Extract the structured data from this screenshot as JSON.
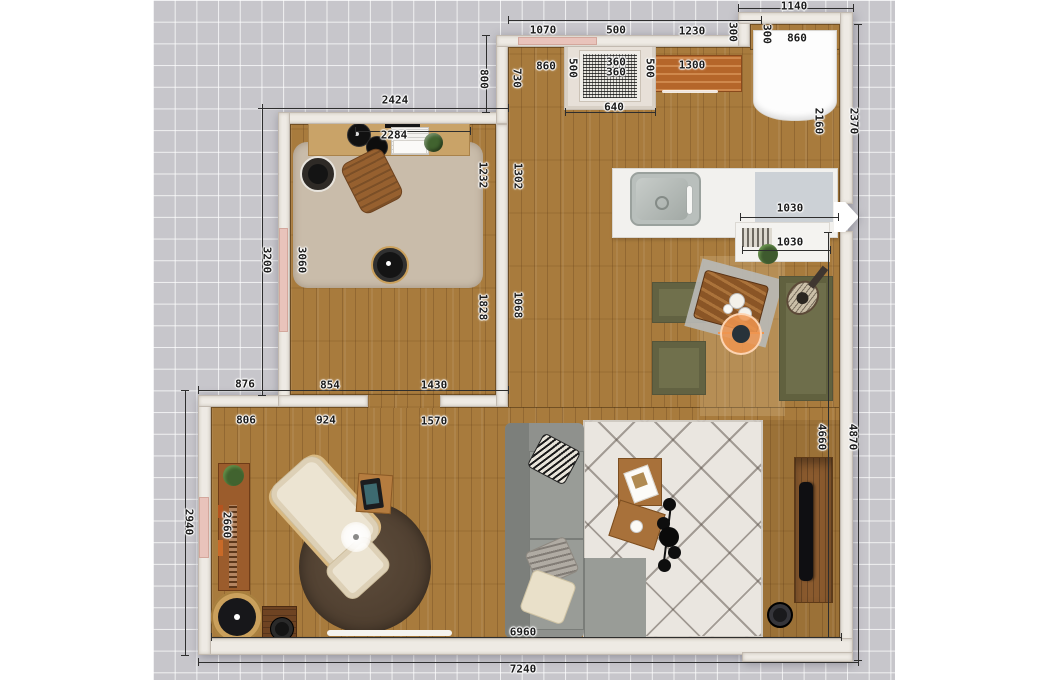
{
  "app": {
    "view": "floor-plan-top-view"
  },
  "canvas": {
    "width": 1050,
    "height": 680,
    "margin_background": "#ffffff",
    "grid": {
      "x": 153,
      "width": 742,
      "background": "#c7c6cb",
      "line_color": "#ffffff",
      "cell_size": 21.7
    }
  },
  "colors": {
    "wall": "#eeeae4",
    "wood_floor": "#a87b3d",
    "window": "#e9c3bb",
    "office_rug": "#c9bcaa",
    "round_rug": "#54432f",
    "area_rug": "#eae6e0",
    "sofa": "#8f918d",
    "dining_green": "#70704c",
    "counter": "#f2f1ee",
    "camera_marker": "#ef9550",
    "bookshelf": "#9b5c2c",
    "tv_console": "#8a5a2e"
  },
  "rooms": [
    {
      "name": "office",
      "floor": "wood"
    },
    {
      "name": "kitchen-dining-living-open-space",
      "floor": "wood"
    }
  ],
  "objects": [
    "desk",
    "desk-monitor",
    "desk-speaker-discs",
    "laptop",
    "desk-papers",
    "desk-plant",
    "office-chair",
    "office-rug",
    "wall-speaker",
    "robot-vacuum",
    "wall-niche",
    "kitchen-dresser",
    "fridge",
    "kitchen-counter",
    "kitchen-sink",
    "faucet",
    "radiator",
    "floor-plant",
    "dining-chair-1",
    "dining-chair-2",
    "dining-table",
    "dining-mat",
    "plates",
    "camera-marker",
    "dining-bench",
    "guitar",
    "bookshelf",
    "shelf-plant",
    "book-spines",
    "lounge-chair",
    "ottoman",
    "glow-lamp",
    "round-rug",
    "side-table",
    "tablet",
    "papasan-chair",
    "pot-table",
    "sofa",
    "pillow-patterned",
    "pillow-gray",
    "pillow-cream",
    "area-rug",
    "coffee-table-1",
    "magazine",
    "coffee-table-2",
    "cup",
    "spider-floor-lamp",
    "tv-console",
    "tv",
    "speaker",
    "door-open-arrow",
    "window-top",
    "window-office",
    "window-living"
  ],
  "dim_labels": [
    {
      "t": "2424",
      "x": 395,
      "y": 100
    },
    {
      "t": "800",
      "x": 484,
      "y": 79,
      "v": 1
    },
    {
      "t": "730",
      "x": 517,
      "y": 78,
      "v": 1
    },
    {
      "t": "1070",
      "x": 543,
      "y": 30
    },
    {
      "t": "500",
      "x": 616,
      "y": 30
    },
    {
      "t": "1230",
      "x": 692,
      "y": 31
    },
    {
      "t": "300",
      "x": 733,
      "y": 32,
      "v": 1
    },
    {
      "t": "1140",
      "x": 794,
      "y": 6
    },
    {
      "t": "300",
      "x": 767,
      "y": 34,
      "v": 1
    },
    {
      "t": "860",
      "x": 797,
      "y": 38
    },
    {
      "t": "860",
      "x": 546,
      "y": 66
    },
    {
      "t": "500",
      "x": 573,
      "y": 68,
      "v": 1
    },
    {
      "t": "360",
      "x": 616,
      "y": 62
    },
    {
      "t": "360",
      "x": 616,
      "y": 72
    },
    {
      "t": "500",
      "x": 650,
      "y": 68,
      "v": 1
    },
    {
      "t": "640",
      "x": 614,
      "y": 107
    },
    {
      "t": "1300",
      "x": 692,
      "y": 65
    },
    {
      "t": "2160",
      "x": 819,
      "y": 121,
      "v": 1
    },
    {
      "t": "2370",
      "x": 854,
      "y": 121,
      "v": 1
    },
    {
      "t": "2284",
      "x": 394,
      "y": 135
    },
    {
      "t": "1232",
      "x": 483,
      "y": 175,
      "v": 1
    },
    {
      "t": "1302",
      "x": 518,
      "y": 176,
      "v": 1
    },
    {
      "t": "1828",
      "x": 483,
      "y": 307,
      "v": 1
    },
    {
      "t": "1068",
      "x": 518,
      "y": 305,
      "v": 1
    },
    {
      "t": "3060",
      "x": 302,
      "y": 260,
      "v": 1
    },
    {
      "t": "3200",
      "x": 267,
      "y": 260,
      "v": 1
    },
    {
      "t": "1030",
      "x": 790,
      "y": 208
    },
    {
      "t": "1030",
      "x": 790,
      "y": 242
    },
    {
      "t": "876",
      "x": 245,
      "y": 384
    },
    {
      "t": "854",
      "x": 330,
      "y": 385
    },
    {
      "t": "1430",
      "x": 434,
      "y": 385
    },
    {
      "t": "806",
      "x": 246,
      "y": 420
    },
    {
      "t": "924",
      "x": 326,
      "y": 420
    },
    {
      "t": "1570",
      "x": 434,
      "y": 421
    },
    {
      "t": "2940",
      "x": 189,
      "y": 522,
      "v": 1
    },
    {
      "t": "2660",
      "x": 227,
      "y": 525,
      "v": 1
    },
    {
      "t": "4660",
      "x": 822,
      "y": 437,
      "v": 1
    },
    {
      "t": "4870",
      "x": 853,
      "y": 437,
      "v": 1
    },
    {
      "t": "6960",
      "x": 523,
      "y": 632
    },
    {
      "t": "7240",
      "x": 523,
      "y": 669
    }
  ],
  "dim_lines": [
    [
      262,
      108,
      508,
      108
    ],
    [
      262,
      108,
      262,
      395
    ],
    [
      185,
      390,
      185,
      655
    ],
    [
      198,
      390,
      508,
      390
    ],
    [
      198,
      662,
      858,
      662
    ],
    [
      211,
      637,
      841,
      637
    ],
    [
      858,
      24,
      858,
      660
    ],
    [
      828,
      232,
      828,
      637
    ],
    [
      738,
      8,
      853,
      8
    ],
    [
      508,
      20,
      761,
      20
    ],
    [
      740,
      217,
      838,
      217
    ],
    [
      742,
      250,
      830,
      250
    ],
    [
      565,
      112,
      655,
      112
    ],
    [
      355,
      131,
      470,
      131
    ],
    [
      486,
      35,
      486,
      112
    ]
  ]
}
